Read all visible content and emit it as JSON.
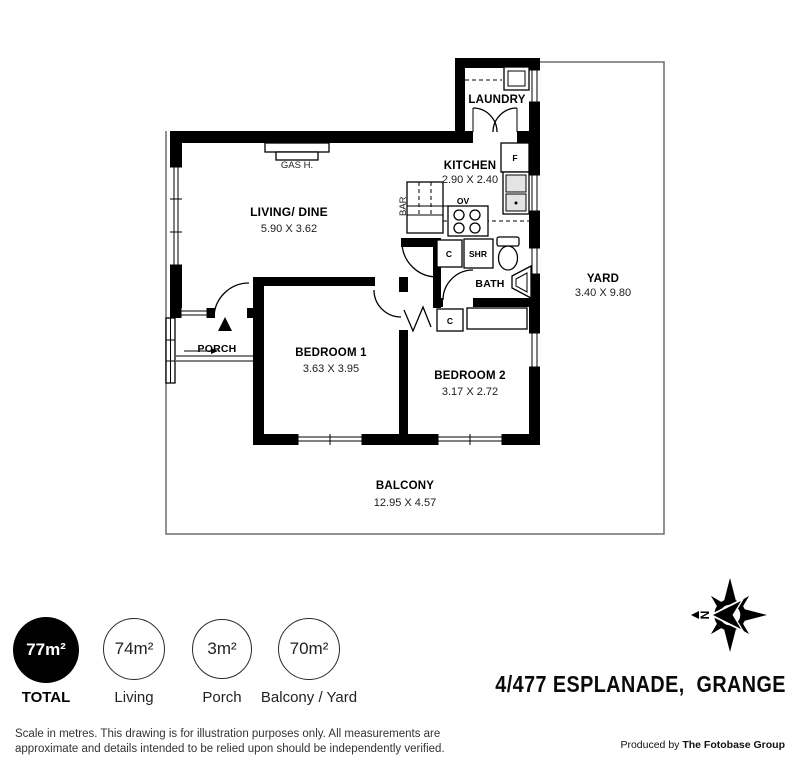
{
  "plan": {
    "rooms": {
      "laundry": {
        "name": "LAUNDRY"
      },
      "kitchen": {
        "name": "KITCHEN",
        "dims": "2.90 X 2.40"
      },
      "living": {
        "name": "LIVING/ DINE",
        "dims": "5.90 X 3.62"
      },
      "yard": {
        "name": "YARD",
        "dims": "3.40 X 9.80"
      },
      "porch": {
        "name": "PORCH"
      },
      "bedroom1": {
        "name": "BEDROOM 1",
        "dims": "3.63 X 3.95"
      },
      "bedroom2": {
        "name": "BEDROOM 2",
        "dims": "3.17 X 2.72"
      },
      "bath": {
        "name": "BATH"
      },
      "balcony": {
        "name": "BALCONY",
        "dims": "12.95 X 4.57"
      }
    },
    "fixtures": {
      "gas_heater": "GAS H.",
      "bar": "BAR",
      "oven": "OV",
      "fridge": "F",
      "shower": "SHR",
      "cupboard": "C"
    },
    "compass_letter": "N"
  },
  "legend": {
    "items": [
      {
        "area": "77m²",
        "label": "TOTAL"
      },
      {
        "area": "74m²",
        "label": "Living"
      },
      {
        "area": "3m²",
        "label": "Porch"
      },
      {
        "area": "70m²",
        "label": "Balcony / Yard"
      }
    ]
  },
  "footer": {
    "address": "4/477 ESPLANADE,  GRANGE",
    "disclaimer_line1": "Scale in metres. This drawing is for illustration purposes only. All measurements are",
    "disclaimer_line2": "approximate and details intended to be relied upon should be independently verified.",
    "produced_prefix": "Produced by ",
    "producer": "The Fotobase Group"
  },
  "colors": {
    "wall": "#000000",
    "boundary": "#6e6e6e",
    "total_circle": "#000000"
  }
}
